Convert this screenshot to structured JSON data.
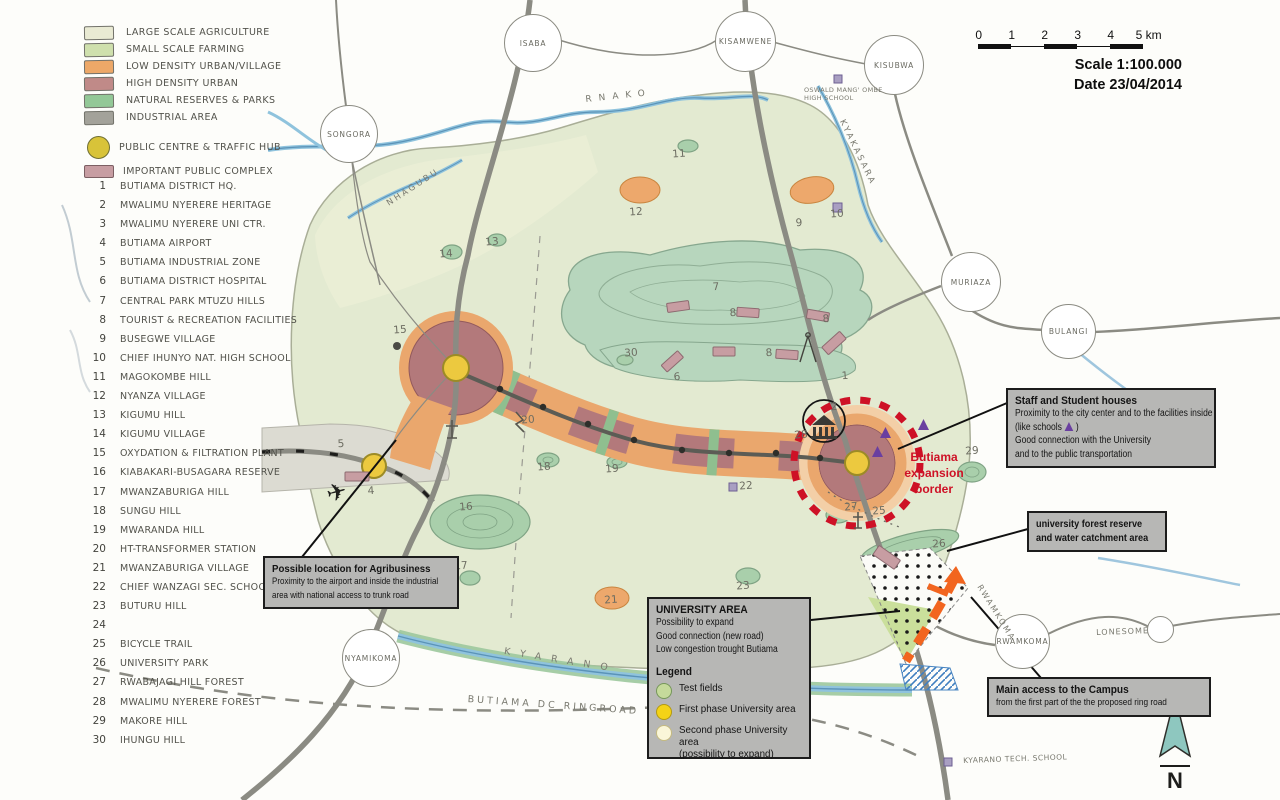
{
  "palette": {
    "accent_red": "#ce1126",
    "road_orange": "#f2651f",
    "school_purple": "#6a3fa0",
    "hub_yellow": "#ecc93f"
  },
  "icons": {
    "airport": "✈"
  },
  "legend": {
    "items": [
      {
        "label": "LARGE SCALE AGRICULTURE",
        "color": "#e9ead3"
      },
      {
        "label": "SMALL SCALE FARMING",
        "color": "#cfe0ad"
      },
      {
        "label": "LOW DENSITY URBAN/VILLAGE",
        "color": "#eda868"
      },
      {
        "label": "HIGH DENSITY URBAN",
        "color": "#c08a88"
      },
      {
        "label": "NATURAL RESERVES & PARKS",
        "color": "#93c897"
      },
      {
        "label": "INDUSTRIAL AREA",
        "color": "#a3a29a"
      }
    ],
    "hub": {
      "label": "PUBLIC CENTRE & TRAFFIC HUB",
      "color": "#d8c339"
    },
    "complex": {
      "label": "IMPORTANT PUBLIC COMPLEX",
      "color": "#c79da2"
    }
  },
  "locations": [
    {
      "num": "1",
      "label": "BUTIAMA DISTRICT HQ."
    },
    {
      "num": "2",
      "label": "MWALIMU NYERERE HERITAGE"
    },
    {
      "num": "3",
      "label": "MWALIMU NYERERE UNI CTR."
    },
    {
      "num": "4",
      "label": "BUTIAMA AIRPORT"
    },
    {
      "num": "5",
      "label": "BUTIAMA INDUSTRIAL ZONE"
    },
    {
      "num": "6",
      "label": "BUTIAMA DISTRICT HOSPITAL"
    },
    {
      "num": "7",
      "label": "CENTRAL PARK MTUZU HILLS"
    },
    {
      "num": "8",
      "label": "TOURIST & RECREATION FACILITIES"
    },
    {
      "num": "9",
      "label": "BUSEGWE VILLAGE"
    },
    {
      "num": "10",
      "label": "CHIEF IHUNYO NAT. HIGH SCHOOL"
    },
    {
      "num": "11",
      "label": "MAGOKOMBE HILL"
    },
    {
      "num": "12",
      "label": "NYANZA VILLAGE"
    },
    {
      "num": "13",
      "label": "KIGUMU HILL"
    },
    {
      "num": "14",
      "label": "KIGUMU VILLAGE"
    },
    {
      "num": "15",
      "label": "OXYDATION & FILTRATION PLANT"
    },
    {
      "num": "16",
      "label": "KIABAKARI-BUSAGARA RESERVE"
    },
    {
      "num": "17",
      "label": "MWANZABURIGA HILL"
    },
    {
      "num": "18",
      "label": "SUNGU HILL"
    },
    {
      "num": "19",
      "label": "MWARANDA HILL"
    },
    {
      "num": "20",
      "label": "HT-TRANSFORMER STATION"
    },
    {
      "num": "21",
      "label": "MWANZABURIGA VILLAGE"
    },
    {
      "num": "22",
      "label": "CHIEF WANZAGI SEC. SCHOOL"
    },
    {
      "num": "23",
      "label": "BUTURU HILL"
    },
    {
      "num": "24",
      "label": ""
    },
    {
      "num": "25",
      "label": "BICYCLE TRAIL"
    },
    {
      "num": "26",
      "label": "UNIVERSITY PARK"
    },
    {
      "num": "27",
      "label": "RWABAJAGI HILL FOREST"
    },
    {
      "num": "28",
      "label": "MWALIMU NYERERE FOREST"
    },
    {
      "num": "29",
      "label": "MAKORE HILL"
    },
    {
      "num": "30",
      "label": "IHUNGU HILL"
    }
  ],
  "scalebar": {
    "ticks": [
      {
        "t": "0",
        "x": 0
      },
      {
        "t": "1",
        "x": 33
      },
      {
        "t": "2",
        "x": 66
      },
      {
        "t": "3",
        "x": 99
      },
      {
        "t": "4",
        "x": 132
      },
      {
        "t": "5 km",
        "x": 168
      }
    ],
    "scale": "Scale 1:100.000",
    "date": "Date 23/04/2014"
  },
  "callouts": {
    "staff": {
      "title": "Staff and Student houses",
      "l1": "Proximity to the city center and to the facilities inside",
      "like_pre": "(like schools",
      "like_post": ")",
      "l3": "Good connection with the University",
      "l4": "and to the public transportation"
    },
    "forest": {
      "l1": "university forest reserve",
      "l2": "and water catchment area"
    },
    "agribusiness": {
      "title": "Possible location for Agribusiness",
      "l1": "Proximity to the airport and inside the industrial",
      "l2": "area with national access to trunk road"
    },
    "university": {
      "title": "UNIVERSITY AREA",
      "l1": "Possibility to expand",
      "l2": "Good connection (new road)",
      "l3": "Low congestion trought Butiama",
      "legend_title": "Legend",
      "items": [
        {
          "label": "Test fields",
          "sub": "",
          "color": "#c5da9b",
          "border": "#76975a"
        },
        {
          "label": "First phase University area",
          "sub": "",
          "color": "#f4d316",
          "border": "#b39a12"
        },
        {
          "label": "Second phase University area",
          "sub": "(possibility to expand)",
          "color": "#faf6d8",
          "border": "#c5ba80"
        }
      ]
    },
    "main_access": {
      "title": "Main access to the Campus",
      "l1": "from the first part of the the proposed  ring road"
    }
  },
  "map": {
    "towns": [
      {
        "name": "ISABA",
        "left": 504,
        "top": 14,
        "size": 56
      },
      {
        "name": "KISAMWENE",
        "left": 715,
        "top": 11,
        "size": 59
      },
      {
        "name": "KISUBWA",
        "left": 864,
        "top": 35,
        "size": 58
      },
      {
        "name": "SONGORA",
        "left": 320,
        "top": 105,
        "size": 56
      },
      {
        "name": "MURIAZA",
        "left": 941,
        "top": 252,
        "size": 58
      },
      {
        "name": "BULANGI",
        "left": 1041,
        "top": 304,
        "size": 53
      },
      {
        "name": "NYAMIKOMA",
        "left": 342,
        "top": 629,
        "size": 56
      },
      {
        "name": "RWAMKOMA",
        "left": 995,
        "top": 614,
        "size": 53
      },
      {
        "name": "",
        "left": 1147,
        "top": 616,
        "size": 25
      }
    ],
    "numbers": [
      {
        "n": "1",
        "x": 845,
        "y": 376
      },
      {
        "n": "2",
        "x": 834,
        "y": 407
      },
      {
        "n": "4",
        "x": 371,
        "y": 491
      },
      {
        "n": "5",
        "x": 341,
        "y": 444
      },
      {
        "n": "6",
        "x": 677,
        "y": 377
      },
      {
        "n": "7",
        "x": 716,
        "y": 287
      },
      {
        "n": "8",
        "x": 733,
        "y": 313
      },
      {
        "n": "8",
        "x": 826,
        "y": 319
      },
      {
        "n": "8",
        "x": 769,
        "y": 353
      },
      {
        "n": "9",
        "x": 799,
        "y": 223
      },
      {
        "n": "10",
        "x": 837,
        "y": 214
      },
      {
        "n": "11",
        "x": 679,
        "y": 154
      },
      {
        "n": "12",
        "x": 636,
        "y": 212
      },
      {
        "n": "13",
        "x": 492,
        "y": 242
      },
      {
        "n": "14",
        "x": 446,
        "y": 254
      },
      {
        "n": "15",
        "x": 400,
        "y": 330
      },
      {
        "n": "16",
        "x": 466,
        "y": 507
      },
      {
        "n": "17",
        "x": 461,
        "y": 566
      },
      {
        "n": "18",
        "x": 544,
        "y": 467
      },
      {
        "n": "19",
        "x": 612,
        "y": 469
      },
      {
        "n": "20",
        "x": 528,
        "y": 420
      },
      {
        "n": "21",
        "x": 611,
        "y": 600
      },
      {
        "n": "22",
        "x": 746,
        "y": 486
      },
      {
        "n": "23",
        "x": 743,
        "y": 586
      },
      {
        "n": "25",
        "x": 879,
        "y": 511
      },
      {
        "n": "26",
        "x": 939,
        "y": 544
      },
      {
        "n": "27",
        "x": 851,
        "y": 507
      },
      {
        "n": "28",
        "x": 801,
        "y": 435
      },
      {
        "n": "29",
        "x": 972,
        "y": 451
      },
      {
        "n": "30",
        "x": 631,
        "y": 353
      }
    ],
    "labels": [
      {
        "text": "RNAKO",
        "left": 585,
        "top": 95,
        "tr": "rotate(-6deg)",
        "ls": "7px",
        "fs": "9px"
      },
      {
        "text": "NHAGUBU",
        "left": 385,
        "top": 200,
        "tr": "rotate(-33deg)",
        "ls": "2.5px",
        "fs": "8.5px"
      },
      {
        "text": "KYAKASARA",
        "left": 846,
        "top": 118,
        "tr": "rotate(64deg)",
        "ls": "2.5px",
        "fs": "8.5px"
      },
      {
        "text": "KYARANO",
        "left": 505,
        "top": 646,
        "tr": "rotate(9deg)",
        "ls": "10px",
        "fs": "9.5px"
      },
      {
        "text": "BUTIAMA  DC  RINGROAD",
        "left": 468,
        "top": 694,
        "tr": "rotate(4deg)",
        "ls": "3px",
        "fs": "9.5px"
      },
      {
        "text": "RWAMKOMA",
        "left": 983,
        "top": 583,
        "tr": "rotate(58deg)",
        "ls": "2px",
        "fs": "8px"
      },
      {
        "text": "LONESOME",
        "left": 1096,
        "top": 628,
        "tr": "rotate(-2deg)",
        "ls": "1px",
        "fs": "8px"
      },
      {
        "text": "KYARANO TECH. SCHOOL",
        "left": 963,
        "top": 756,
        "tr": "rotate(-2deg)",
        "ls": "0.5px",
        "fs": "7.5px"
      },
      {
        "text": "OSWALD MANG' OMBE HIGH SCHOOL",
        "left": 804,
        "top": 86,
        "tr": "none",
        "ls": "0.3px",
        "fs": "6.5px",
        "w": "80px",
        "wsp": "normal"
      }
    ],
    "expansion": {
      "l1": "Butiama",
      "l2": "expansion",
      "l3": "border"
    },
    "compass_n": "N"
  }
}
